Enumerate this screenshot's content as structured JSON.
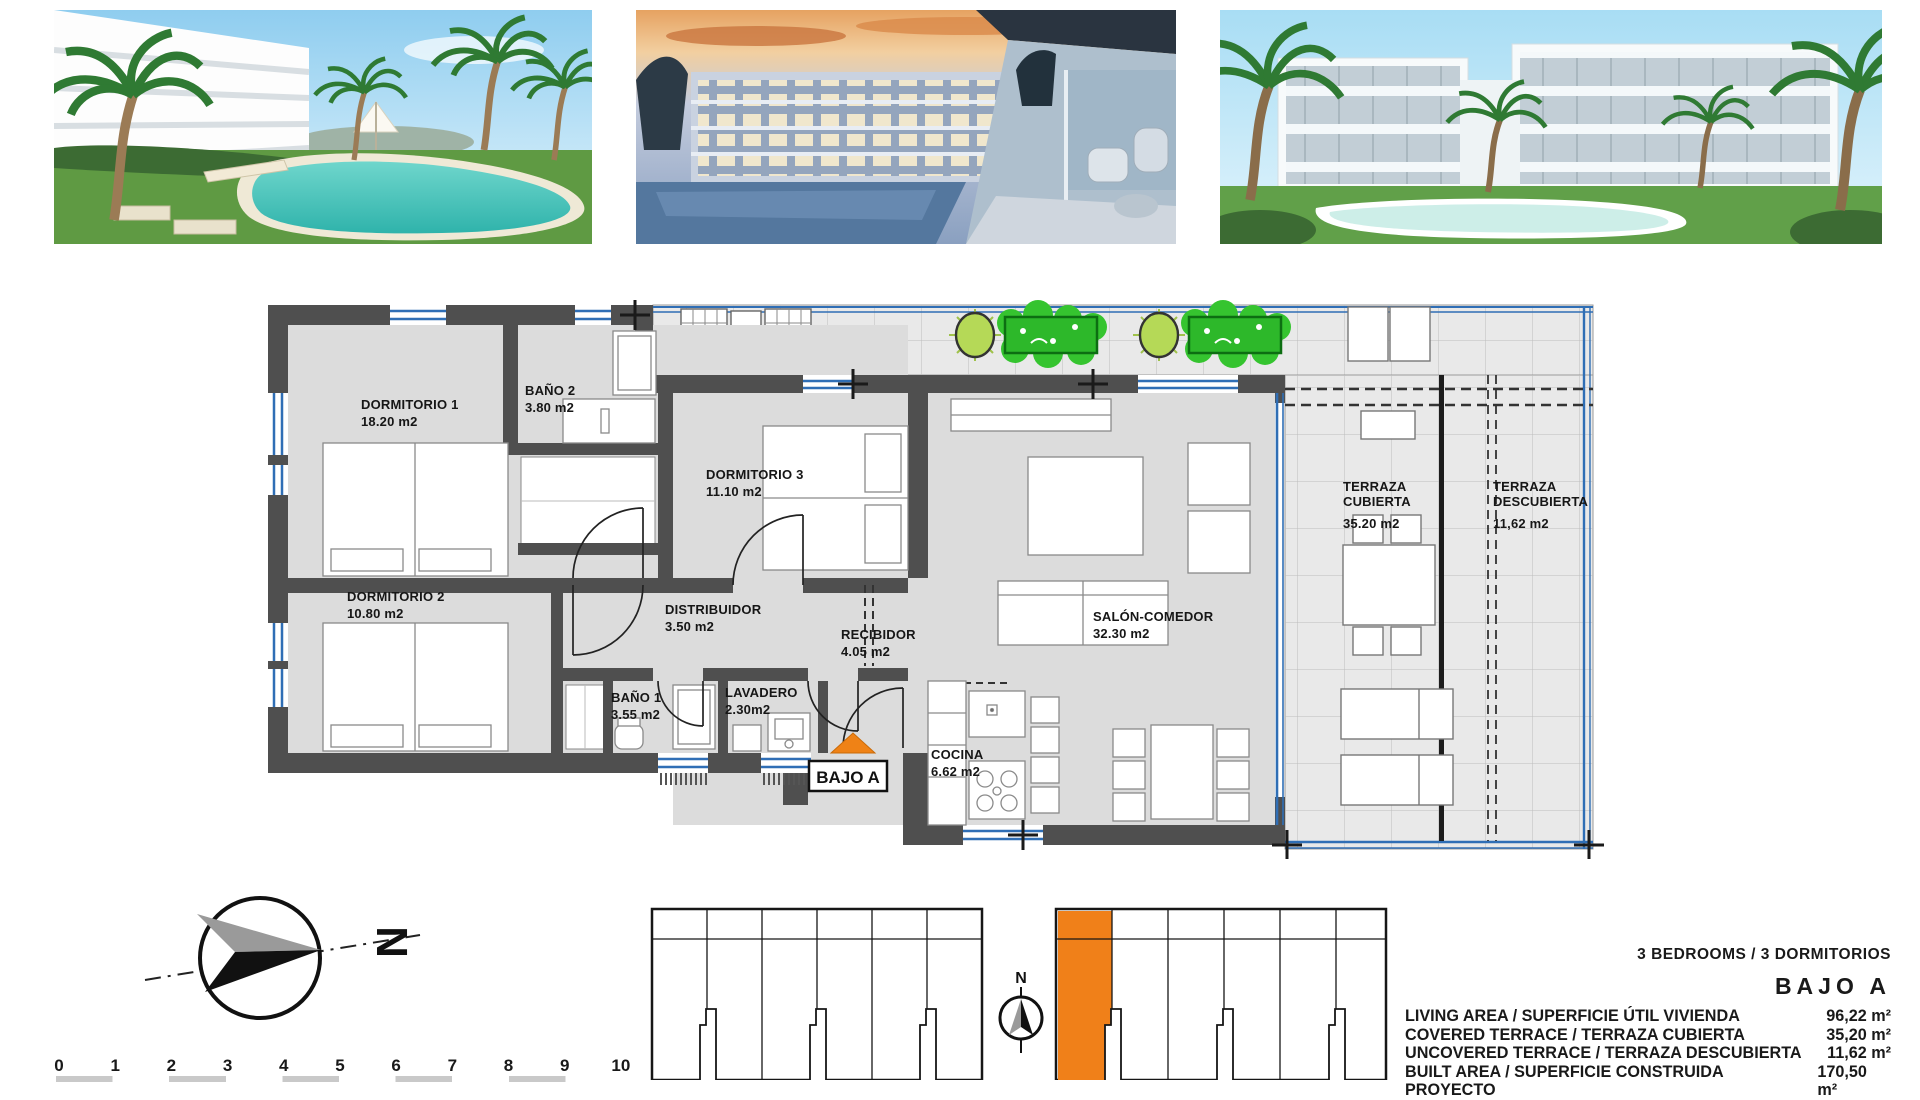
{
  "photos": [
    {
      "name": "pool-garden-render"
    },
    {
      "name": "dusk-terrace-render"
    },
    {
      "name": "building-elevation-render"
    }
  ],
  "floor_plan": {
    "entrance_label": "BAJO A",
    "rooms": [
      {
        "label": "DORMITORIO 1",
        "area": "18.20 m2"
      },
      {
        "label": "BAÑO 2",
        "area": "3.80 m2"
      },
      {
        "label": "DORMITORIO 3",
        "area": "11.10 m2"
      },
      {
        "label": "DORMITORIO 2",
        "area": "10.80 m2"
      },
      {
        "label": "DISTRIBUIDOR",
        "area": "3.50 m2"
      },
      {
        "label": "RECIBIDOR",
        "area": "4.05 m2"
      },
      {
        "label": "BAÑO 1",
        "area": "3.55 m2"
      },
      {
        "label": "LAVADERO",
        "area": "2.30m2"
      },
      {
        "label": "SALÓN-COMEDOR",
        "area": "32.30 m2"
      },
      {
        "label": "COCINA",
        "area": "6.62 m2"
      },
      {
        "label": "TERRAZA",
        "label2": "CUBIERTA",
        "area": "35.20 m2"
      },
      {
        "label": "TERRAZA",
        "label2": "DESCUBIERTA",
        "area": "11,62 m2"
      }
    ]
  },
  "compass": {
    "north": "N"
  },
  "key_plan": {
    "north": "N"
  },
  "scale_bar": {
    "ticks": [
      "0",
      "1",
      "2",
      "3",
      "4",
      "5",
      "6",
      "7",
      "8",
      "9",
      "10"
    ]
  },
  "summary": {
    "bedrooms_line": "3 BEDROOMS / 3 DORMITORIOS",
    "unit": "BAJO A",
    "rows": [
      {
        "label": "LIVING AREA / SUPERFICIE ÚTIL VIVIENDA",
        "value": "96,22 m²"
      },
      {
        "label": "COVERED TERRACE / TERRAZA CUBIERTA",
        "value": "35,20 m²"
      },
      {
        "label": "UNCOVERED TERRACE / TERRAZA DESCUBIERTA",
        "value": "11,62 m²"
      },
      {
        "label": "BUILT AREA / SUPERFICIE CONSTRUIDA PROYECTO",
        "value": "170,50 m²"
      }
    ]
  },
  "colors": {
    "accent_orange": "#f08019",
    "glazing_blue": "#2f6eb5",
    "plant_green": "#2db82a",
    "wall_gray": "#4f4f4f"
  }
}
